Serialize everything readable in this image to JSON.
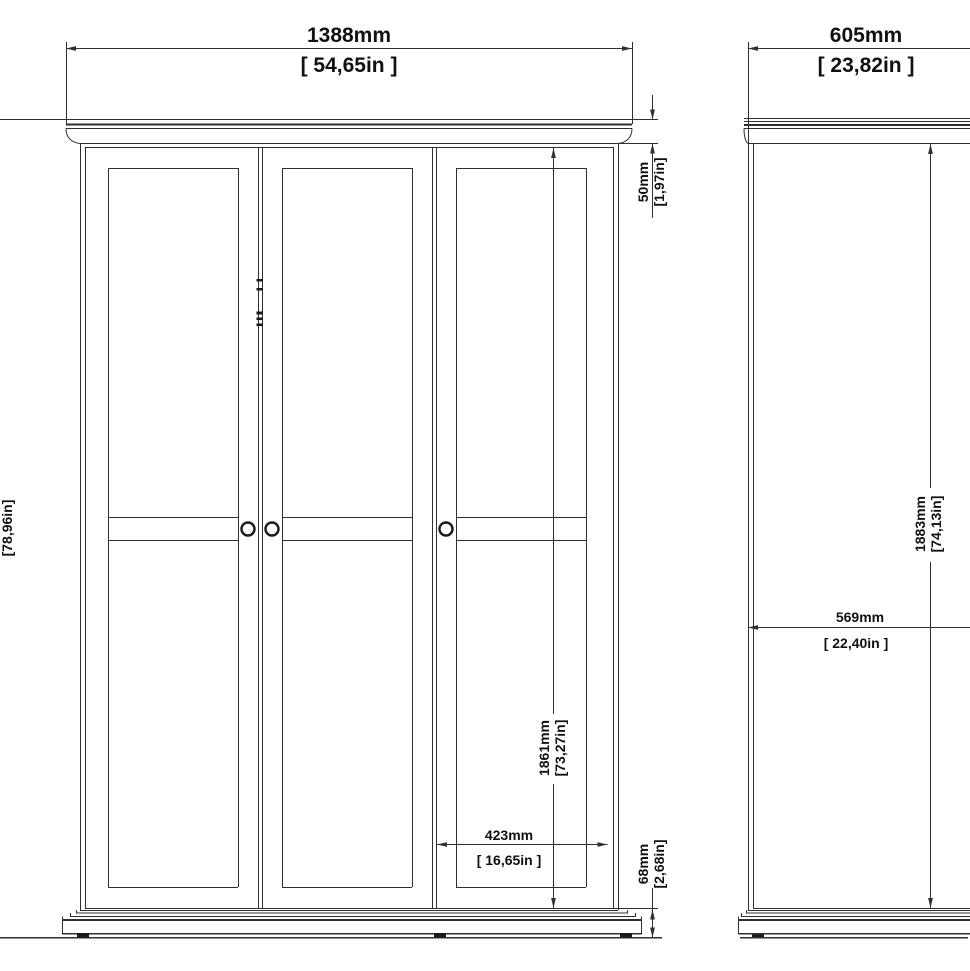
{
  "colors": {
    "line": "#303030",
    "text": "#111111",
    "background": "#ffffff"
  },
  "front_view": {
    "width": {
      "mm": "1388mm",
      "inches": "[ 54,65in ]"
    },
    "overall_height": {
      "inches": "[78,96in]"
    },
    "cornice_height": {
      "mm": "50mm",
      "inches": "[1,97in]"
    },
    "door_height": {
      "mm": "1861mm",
      "inches": "[73,27in]"
    },
    "door_width": {
      "mm": "423mm",
      "inches": "[ 16,65in ]"
    },
    "plinth_height": {
      "mm": "68mm",
      "inches": "[2,68in]"
    }
  },
  "side_view": {
    "depth": {
      "mm": "605mm",
      "inches": "[ 23,82in ]"
    },
    "body_height": {
      "mm": "1883mm",
      "inches": "[74,13in]"
    },
    "interior_depth": {
      "mm": "569mm",
      "inches": "[ 22,40in ]"
    }
  }
}
